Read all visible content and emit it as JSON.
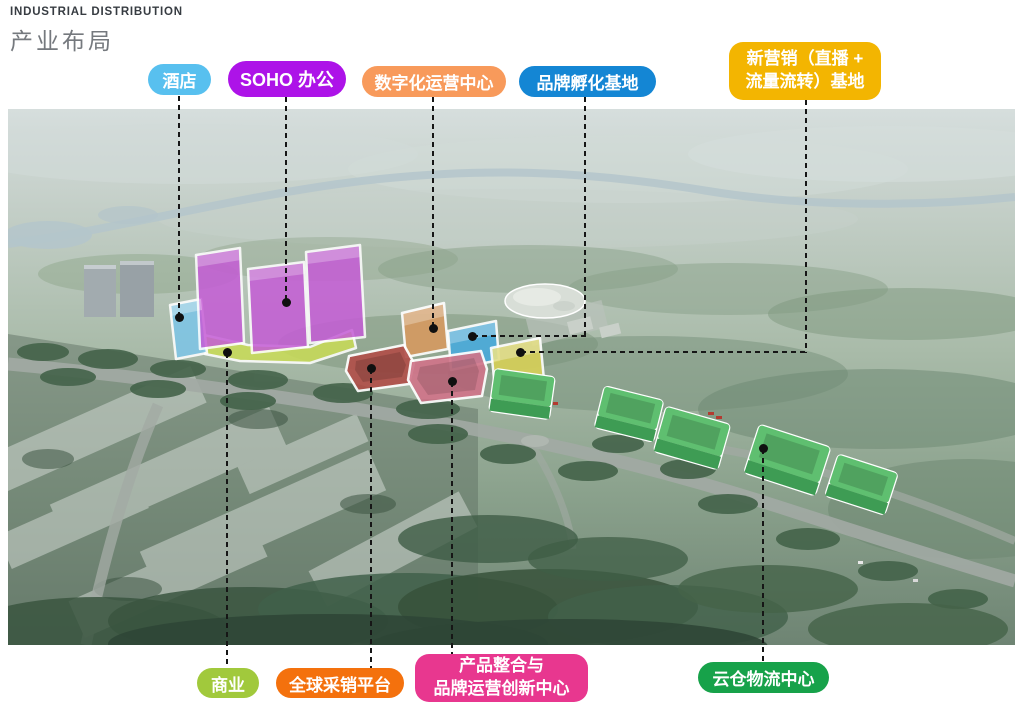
{
  "header": {
    "title_en": "INDUSTRIAL DISTRIBUTION",
    "title_zh": "产业布局"
  },
  "labels": {
    "hotel": {
      "text": "酒店",
      "color": "#58C0EF"
    },
    "soho": {
      "text": "SOHO 办公",
      "color": "#AD13E8"
    },
    "digital_ops": {
      "text": "数字化运营中心",
      "color": "#F89A5B"
    },
    "brand_incubation": {
      "text": "品牌孵化基地",
      "color": "#1486D4"
    },
    "new_marketing": {
      "line1": "新营销（直播 +",
      "line2": "流量流转）基地",
      "color": "#F3B501"
    },
    "commerce": {
      "text": "商业",
      "color": "#A1C93C"
    },
    "global_sourcing": {
      "text": "全球采销平台",
      "color": "#F4710D"
    },
    "product_integration": {
      "line1": "产品整合与",
      "line2": "品牌运营创新中心",
      "color": "#E8378F"
    },
    "cloud_logistics": {
      "text": "云仓物流中心",
      "color": "#17A24A"
    }
  },
  "map": {
    "zones": {
      "hotel": {
        "fill": "#7EC5E6"
      },
      "soho": {
        "fill": "#C55CD6"
      },
      "commerce": {
        "fill": "#C8DB59"
      },
      "digital_ops": {
        "fill": "#D69A61"
      },
      "brand_incubation": {
        "fill": "#49ABDC"
      },
      "new_marketing": {
        "fill": "#D8D158"
      },
      "global_sourcing": {
        "fill": "#B1504A"
      },
      "product_integration": {
        "fill": "#D0758A"
      },
      "cloud_logistics": {
        "roof": "#5FBF70",
        "side": "#3E9C54"
      }
    }
  }
}
